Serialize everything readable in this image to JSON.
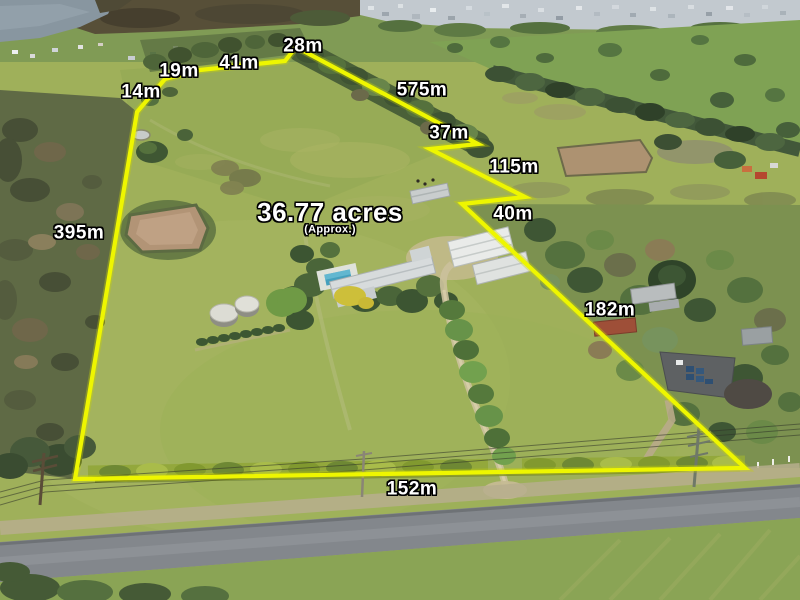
{
  "overlay": {
    "area": {
      "value": "36.77 acres",
      "qualifier": "(Approx.)"
    },
    "boundary_color": "#eef600",
    "label_color": "#ffffff",
    "measurements": [
      {
        "id": "seg-14m",
        "text": "14m"
      },
      {
        "id": "seg-19m",
        "text": "19m"
      },
      {
        "id": "seg-41m",
        "text": "41m"
      },
      {
        "id": "seg-28m",
        "text": "28m"
      },
      {
        "id": "seg-575m",
        "text": "575m"
      },
      {
        "id": "seg-37m",
        "text": "37m"
      },
      {
        "id": "seg-115m",
        "text": "115m"
      },
      {
        "id": "seg-40m",
        "text": "40m"
      },
      {
        "id": "seg-395m",
        "text": "395m"
      },
      {
        "id": "seg-182m",
        "text": "182m"
      },
      {
        "id": "seg-152m",
        "text": "152m"
      }
    ]
  },
  "scene": {
    "description_colors": {
      "paddock_grass": "#9fb05a",
      "boundary_line": "#eef600",
      "dam_water": "#b29476",
      "lake_water": "#8896a0",
      "road_asphalt": "#83878c",
      "pool_water": "#45a0bd",
      "hedge": "#93a83c"
    }
  }
}
